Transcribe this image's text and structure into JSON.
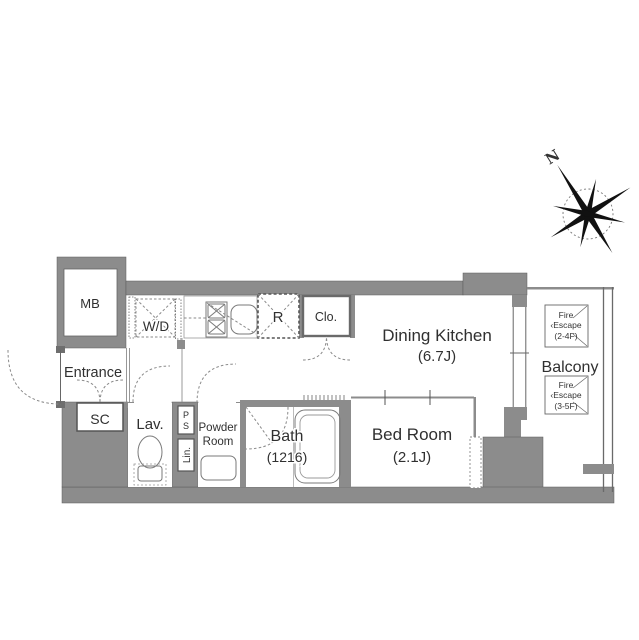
{
  "plan": {
    "compass_n": "N",
    "labels": {
      "mb": "MB",
      "wd": "W/D",
      "entrance": "Entrance",
      "sc": "SC",
      "lav": "Lav.",
      "ps_p": "P",
      "ps_s": "S",
      "lin": "Lin.",
      "powder1": "Powder",
      "powder2": "Room",
      "bath": "Bath",
      "bath_size": "(1216)",
      "fridge": "R",
      "closet": "Clo.",
      "dk": "Dining Kitchen",
      "dk_size": "(6.7J)",
      "bed": "Bed Room",
      "bed_size": "(2.1J)",
      "balcony": "Balcony"
    },
    "fire_escape_upper": {
      "l1": "Fire",
      "l2": "‹Escape",
      "l3": "(2-4F)"
    },
    "fire_escape_lower": {
      "l1": "Fire",
      "l2": "‹Escape",
      "l3": "(3-5F)"
    },
    "colors": {
      "wall": "#8c8c8c",
      "outline": "#555555",
      "text": "#333333"
    }
  }
}
